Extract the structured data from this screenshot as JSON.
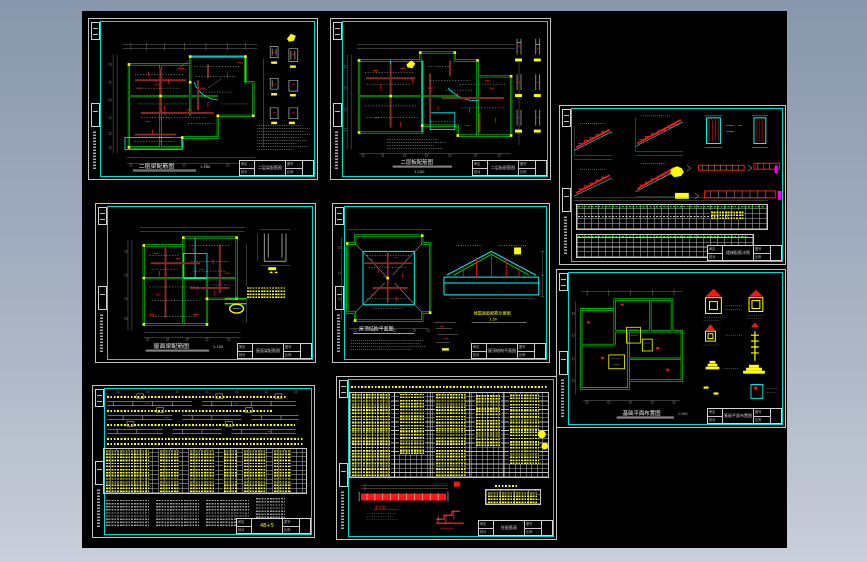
{
  "app": {
    "background_top": "#8897ab",
    "background_bottom": "#c9cfda",
    "canvas_color": "#000000"
  },
  "palette": {
    "wall_green": "#00f000",
    "highlight_cyan": "#00ffff",
    "beam_dark_red": "#8c2822",
    "mark_red": "#ff1515",
    "label_yellow": "#ffff00",
    "dim_gray": "#8f8f8f",
    "text_white": "#d8d8d8",
    "accent_magenta": "#ff00ff"
  },
  "titleblock": {
    "design_label": "设计",
    "check_label": "校对",
    "audit_label": "审定",
    "no_label": "图号",
    "scale_label": "比例"
  },
  "sheets": {
    "s1": {
      "title": "二层梁配筋图",
      "scale": "1:100"
    },
    "s2": {
      "title": "二层板配筋图",
      "scale": "1:100"
    },
    "s3": {
      "title": "楼梯配筋详图",
      "scale": "1:50"
    },
    "s4": {
      "title": "屋面梁配筋图",
      "scale": "1:100"
    },
    "s5": {
      "title": "屋顶结构平面图",
      "scale": "1:50",
      "highlight": "坡屋面板配筋示意图",
      "highlight_scale": "1:50"
    },
    "s6": {
      "title": "基础平面布置图",
      "scale": "1:100"
    },
    "s7": {
      "title": "梁配筋表",
      "tb_no": "4B+5"
    },
    "s8": {
      "title": "柱配筋表",
      "detail_label": "梁详图"
    }
  }
}
